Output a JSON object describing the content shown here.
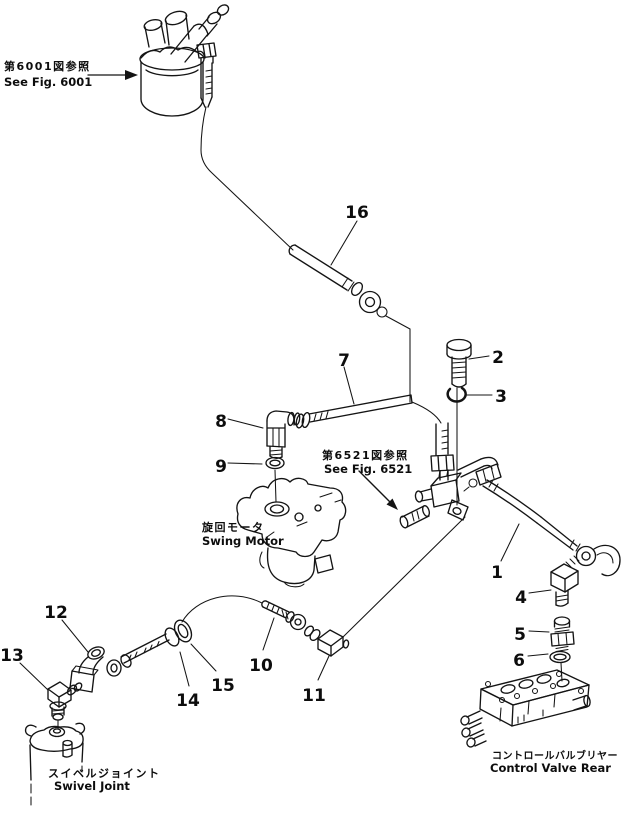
{
  "diagram": {
    "type": "parts-line-drawing",
    "background_color": "#ffffff",
    "line_color": "#141414",
    "figure_references": {
      "fig6001": {
        "jp": "第6001図参照",
        "en": "See Fig. 6001"
      },
      "fig6521": {
        "jp": "第6521図参照",
        "en": "See Fig. 6521"
      }
    },
    "component_labels": {
      "swing_motor": {
        "jp": "旋回モータ",
        "en": "Swing Motor"
      },
      "swivel_joint": {
        "jp": "スイベルジョイント",
        "en": "Swivel Joint"
      },
      "control_valve_rear": {
        "jp": "コントロールバルブリヤー",
        "en": "Control Valve Rear"
      }
    },
    "callouts": [
      "1",
      "2",
      "3",
      "4",
      "5",
      "6",
      "7",
      "8",
      "9",
      "10",
      "11",
      "12",
      "13",
      "14",
      "15",
      "16"
    ]
  }
}
